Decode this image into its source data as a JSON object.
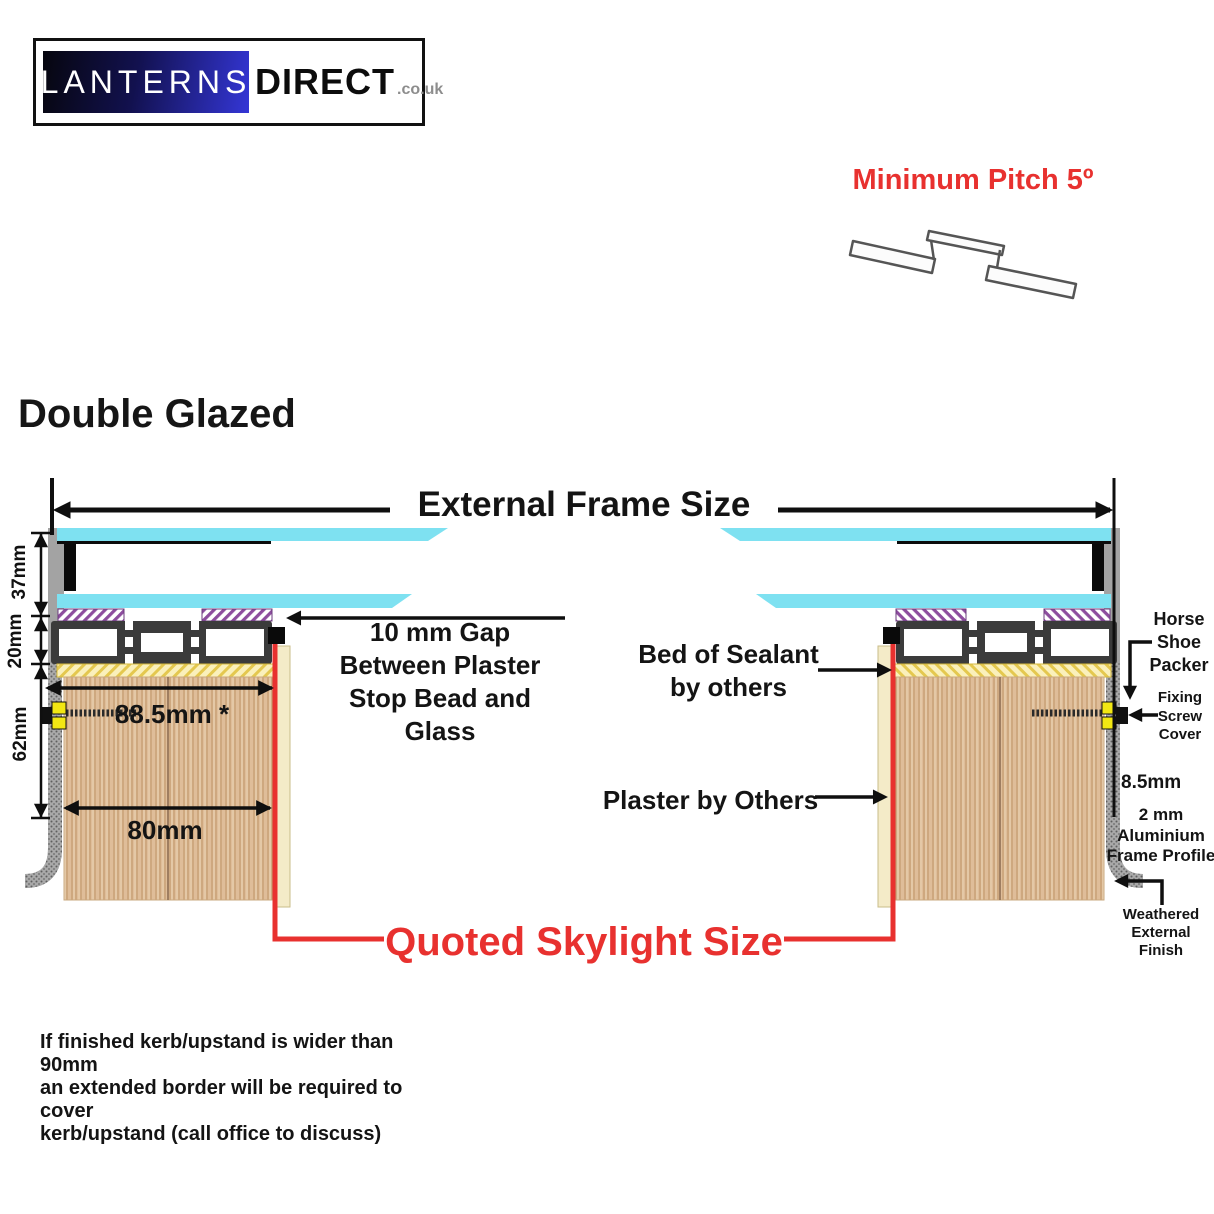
{
  "logo": {
    "lanterns": "LANTERNS",
    "direct": "DIRECT",
    "tld": ".co.uk"
  },
  "minimum_pitch": "Minimum Pitch 5º",
  "title": "Double Glazed",
  "diagram": {
    "external_frame_size": "External Frame Size",
    "dims": {
      "d37": "37mm",
      "d20": "20mm",
      "d62": "62mm",
      "d885": "88.5mm *",
      "d80": "80mm",
      "d85": "8.5mm"
    },
    "labels": {
      "gap": "10 mm Gap\nBetween Plaster\nStop Bead and\nGlass",
      "sealant": "Bed of Sealant\nby others",
      "plaster": "Plaster by Others",
      "horse_shoe": "Horse\nShoe\nPacker",
      "fixing_screw": "Fixing\nScrew\nCover",
      "frame_profile": "2 mm\nAluminium\nFrame Profile",
      "weathered": "Weathered\nExternal\nFinish",
      "quoted": "Quoted Skylight Size"
    }
  },
  "footnote": "If finished kerb/upstand is wider than 90mm\nan extended border will be required to cover\nkerb/upstand (call office to discuss)",
  "colors": {
    "accent_red": "#e8312f",
    "glass_cyan": "#7ee1f1",
    "frame_dark": "#3b3b3b",
    "wood": "#dfbd99",
    "packer_yellow": "#f2e713",
    "logo_blue": "#3436d6",
    "purple_hatch": "#8d4d9e",
    "yellow_hatch": "#e4c84f"
  }
}
